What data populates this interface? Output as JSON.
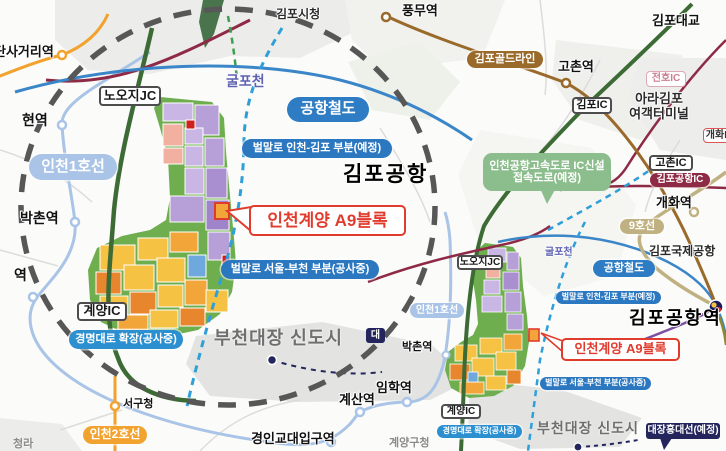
{
  "map_title": "인천계양 A9블록 위치도",
  "colors": {
    "line_blue": "#2e7cc3",
    "roadlabel_blue": "#2b77c0",
    "line_lightblue": "#a9c4e6",
    "line_orange": "#f2a22e",
    "line_brown": "#9a6a2b",
    "line_tan": "#c0b183",
    "ic_maroon": "#8e2a45",
    "plan_navy": "#23255c",
    "callout_red": "#e03c2d",
    "access_green": "#8cbd8c",
    "circle_gray": "#575757"
  },
  "labels": [
    {
      "id": "dansageori-station-label",
      "text": "단사거리역",
      "type": "plain",
      "x": -6,
      "y": 45,
      "fs": 13
    },
    {
      "id": "gimpo-cityhall-label",
      "text": "김포시청",
      "type": "plain-dark",
      "x": 276,
      "y": 8,
      "fs": 12
    },
    {
      "id": "pungmu-station-label",
      "text": "풍무역",
      "type": "plain",
      "x": 402,
      "y": 4,
      "fs": 13
    },
    {
      "id": "gimpo-bridge-label",
      "text": "김포대교",
      "type": "plain",
      "x": 652,
      "y": 14,
      "fs": 13
    },
    {
      "id": "gimpo-goldline-badge",
      "text": "김포골드라인",
      "type": "pill",
      "color": "#9a6a2b",
      "x": 467,
      "y": 51,
      "w": 76,
      "h": 17,
      "fs": 11
    },
    {
      "id": "gochon-station-label",
      "text": "고촌역",
      "type": "plain",
      "x": 558,
      "y": 60,
      "fs": 13
    },
    {
      "id": "jeonho-ic-badge",
      "text": "전호IC",
      "type": "box-pink",
      "x": 646,
      "y": 71,
      "w": 40,
      "h": 16,
      "fs": 10
    },
    {
      "id": "ara-gimpo-terminal-label",
      "text": "아라김포\n여객터미널",
      "type": "plain-dark",
      "x": 626,
      "y": 92,
      "w": 66,
      "fs": 13
    },
    {
      "id": "gimpo-ic-badge",
      "text": "김포IC",
      "type": "box",
      "x": 572,
      "y": 97,
      "w": 40,
      "h": 17,
      "fs": 11
    },
    {
      "id": "nooji-jc-badge-big",
      "text": "노오지JC",
      "type": "box",
      "x": 99,
      "y": 86,
      "w": 62,
      "h": 20,
      "fs": 13
    },
    {
      "id": "gulpocheon-label-big",
      "text": "굴포천",
      "type": "stream",
      "x": 226,
      "y": 74,
      "fs": 14
    },
    {
      "id": "arex-badge-big",
      "text": "공항철도",
      "type": "pill",
      "color": "#2e7cc3",
      "x": 287,
      "y": 97,
      "w": 82,
      "h": 25,
      "fs": 15
    },
    {
      "id": "beolmallo-incheon-gimpo-badge-big",
      "text": "벌말로 인천-김포 부분(예정)",
      "type": "pill",
      "color": "#2b77c0",
      "x": 242,
      "y": 139,
      "w": 150,
      "h": 19,
      "fs": 11
    },
    {
      "id": "incheon-line1-badge-big",
      "text": "인천1호선",
      "type": "pill",
      "color": "#a9c4e6",
      "x": 29,
      "y": 154,
      "w": 88,
      "h": 26,
      "fs": 15
    },
    {
      "id": "gimpo-airport-label",
      "text": "김포공항",
      "type": "bigtext",
      "x": 343,
      "y": 163,
      "fs": 21
    },
    {
      "id": "a9-block-callout-big",
      "text": "인천계양 A9블록",
      "type": "redbox",
      "x": 249,
      "y": 205,
      "w": 157,
      "h": 31,
      "fs": 17
    },
    {
      "id": "bakchon-station-label-big",
      "text": "박촌역",
      "type": "plain",
      "x": 20,
      "y": 211,
      "fs": 14
    },
    {
      "id": "beolmallo-seoul-bucheon-badge-big",
      "text": "벌말로 서울-부천 부분(공사중)",
      "type": "pill",
      "color": "#2b77c0",
      "x": 221,
      "y": 260,
      "w": 158,
      "h": 19,
      "fs": 11
    },
    {
      "id": "hyeon-station-label",
      "text": "현역",
      "type": "plain",
      "x": 22,
      "y": 113,
      "fs": 14
    },
    {
      "id": "station-label-partial",
      "text": "역",
      "type": "plain",
      "x": 14,
      "y": 268,
      "fs": 14
    },
    {
      "id": "gyeyang-ic-badge-big",
      "text": "계양IC",
      "type": "box",
      "x": 77,
      "y": 302,
      "w": 50,
      "h": 19,
      "fs": 13
    },
    {
      "id": "gyeongmyeong-badge-big",
      "text": "경명대로 확장(공사중)",
      "type": "pill",
      "color": "#2b8fd0",
      "x": 69,
      "y": 330,
      "w": 114,
      "h": 19,
      "fs": 11
    },
    {
      "id": "bucheon-daejang-label-big",
      "text": "부천대장 신도시",
      "type": "graybig",
      "x": 214,
      "y": 328,
      "fs": 18
    },
    {
      "id": "seogucheong-station-label",
      "text": "서구청",
      "type": "plain",
      "x": 123,
      "y": 398,
      "fs": 11
    },
    {
      "id": "incheon-line2-badge",
      "text": "인천2호선",
      "type": "pill",
      "color": "#f2a22e",
      "x": 83,
      "y": 426,
      "w": 64,
      "h": 18,
      "fs": 12
    },
    {
      "id": "cheongna-label",
      "text": "청라",
      "type": "gray",
      "x": 13,
      "y": 438,
      "fs": 11
    },
    {
      "id": "gyeongin-edu-station-label",
      "text": "경인교대입구역",
      "type": "plain",
      "x": 251,
      "y": 432,
      "fs": 13
    },
    {
      "id": "gyesan-station-label",
      "text": "계산역",
      "type": "plain",
      "x": 339,
      "y": 393,
      "fs": 13
    },
    {
      "id": "imhak-station-label",
      "text": "임학역",
      "type": "plain",
      "x": 376,
      "y": 381,
      "fs": 13
    },
    {
      "id": "gyeyang-gucheong-label",
      "text": "계양구청",
      "type": "gray",
      "x": 389,
      "y": 437,
      "fs": 11
    },
    {
      "id": "line9-badge",
      "text": "9호선",
      "type": "pill",
      "color": "#c0b183",
      "x": 620,
      "y": 219,
      "w": 44,
      "h": 15,
      "fs": 11
    },
    {
      "id": "gimpo-intl-airport-label",
      "text": "김포국제공항",
      "type": "plain-dark",
      "x": 649,
      "y": 245,
      "fs": 12
    },
    {
      "id": "arex-badge-small",
      "text": "공항철도",
      "type": "pill",
      "color": "#2e7cc3",
      "x": 593,
      "y": 260,
      "w": 62,
      "h": 17,
      "fs": 11
    },
    {
      "id": "beolmallo-incheon-gimpo-badge-small",
      "text": "벌말로 인천-김포 부분(예정)",
      "type": "pill",
      "color": "#2b77c0",
      "x": 556,
      "y": 291,
      "w": 105,
      "h": 13,
      "fs": 8
    },
    {
      "id": "gimpo-airport-station-label",
      "text": "김포공항역",
      "type": "bigtext",
      "x": 629,
      "y": 308,
      "fs": 18
    },
    {
      "id": "a9-block-callout-small",
      "text": "인천계양 A9블록",
      "type": "redbox",
      "x": 561,
      "y": 338,
      "w": 119,
      "h": 23,
      "fs": 13
    },
    {
      "id": "beolmallo-seoul-bucheon-badge-small",
      "text": "벌말로 서울-부천 부분(공사중)",
      "type": "pill",
      "color": "#2b77c0",
      "x": 540,
      "y": 377,
      "w": 111,
      "h": 13,
      "fs": 8
    },
    {
      "id": "bucheon-daejang-label-small",
      "text": "부천대장 신도시",
      "type": "graybig",
      "x": 537,
      "y": 421,
      "fs": 14
    },
    {
      "id": "daejang-hongdae-line-badge",
      "text": "대장홍대선(예정)",
      "type": "navybox",
      "x": 646,
      "y": 423,
      "w": 74,
      "h": 16,
      "fs": 10
    },
    {
      "id": "nooji-jc-badge-small",
      "text": "노오지JC",
      "type": "box",
      "x": 457,
      "y": 255,
      "w": 46,
      "h": 15,
      "fs": 10
    },
    {
      "id": "gulpocheon-label-small",
      "text": "굴포천",
      "type": "stream",
      "x": 545,
      "y": 247,
      "fs": 10
    },
    {
      "id": "incheon-line1-badge-small",
      "text": "인천1호선",
      "type": "pill",
      "color": "#a9c4e6",
      "x": 410,
      "y": 303,
      "w": 54,
      "h": 15,
      "fs": 10
    },
    {
      "id": "bakchon-station-label-small",
      "text": "박촌역",
      "type": "plain",
      "x": 402,
      "y": 341,
      "fs": 11
    },
    {
      "id": "gyeyang-ic-badge-small",
      "text": "계양IC",
      "type": "box",
      "x": 441,
      "y": 404,
      "w": 40,
      "h": 15,
      "fs": 10
    },
    {
      "id": "gyeongmyeong-badge-small",
      "text": "경명대로 확장(공사중)",
      "type": "pill",
      "color": "#2b8fd0",
      "x": 437,
      "y": 425,
      "w": 85,
      "h": 13,
      "fs": 8
    },
    {
      "id": "gochon-ic-badge",
      "text": "고촌IC",
      "type": "box",
      "x": 649,
      "y": 155,
      "w": 44,
      "h": 16,
      "fs": 11
    },
    {
      "id": "gimpo-airport-ic-badge",
      "text": "김포공항IC",
      "type": "pill",
      "color": "#8e2a45",
      "x": 650,
      "y": 173,
      "w": 60,
      "h": 14,
      "fs": 10
    },
    {
      "id": "gaehwa-station-label",
      "text": "개화역",
      "type": "plain",
      "x": 656,
      "y": 196,
      "fs": 13
    },
    {
      "id": "gaehwa-ic-badge",
      "text": "개화IC",
      "type": "box-red",
      "x": 703,
      "y": 128,
      "w": 34,
      "h": 15,
      "fs": 10
    },
    {
      "id": "ic-access-road-callout",
      "text": "인천공항고속도로 IC신설\n접속도로(예정)",
      "type": "greenbox",
      "x": 483,
      "y": 153,
      "w": 128,
      "h": 38,
      "fs": 11
    },
    {
      "id": "daejang-partial-badge",
      "text": "대",
      "type": "navybox",
      "x": 366,
      "y": 328,
      "w": 19,
      "h": 15,
      "fs": 10
    }
  ]
}
